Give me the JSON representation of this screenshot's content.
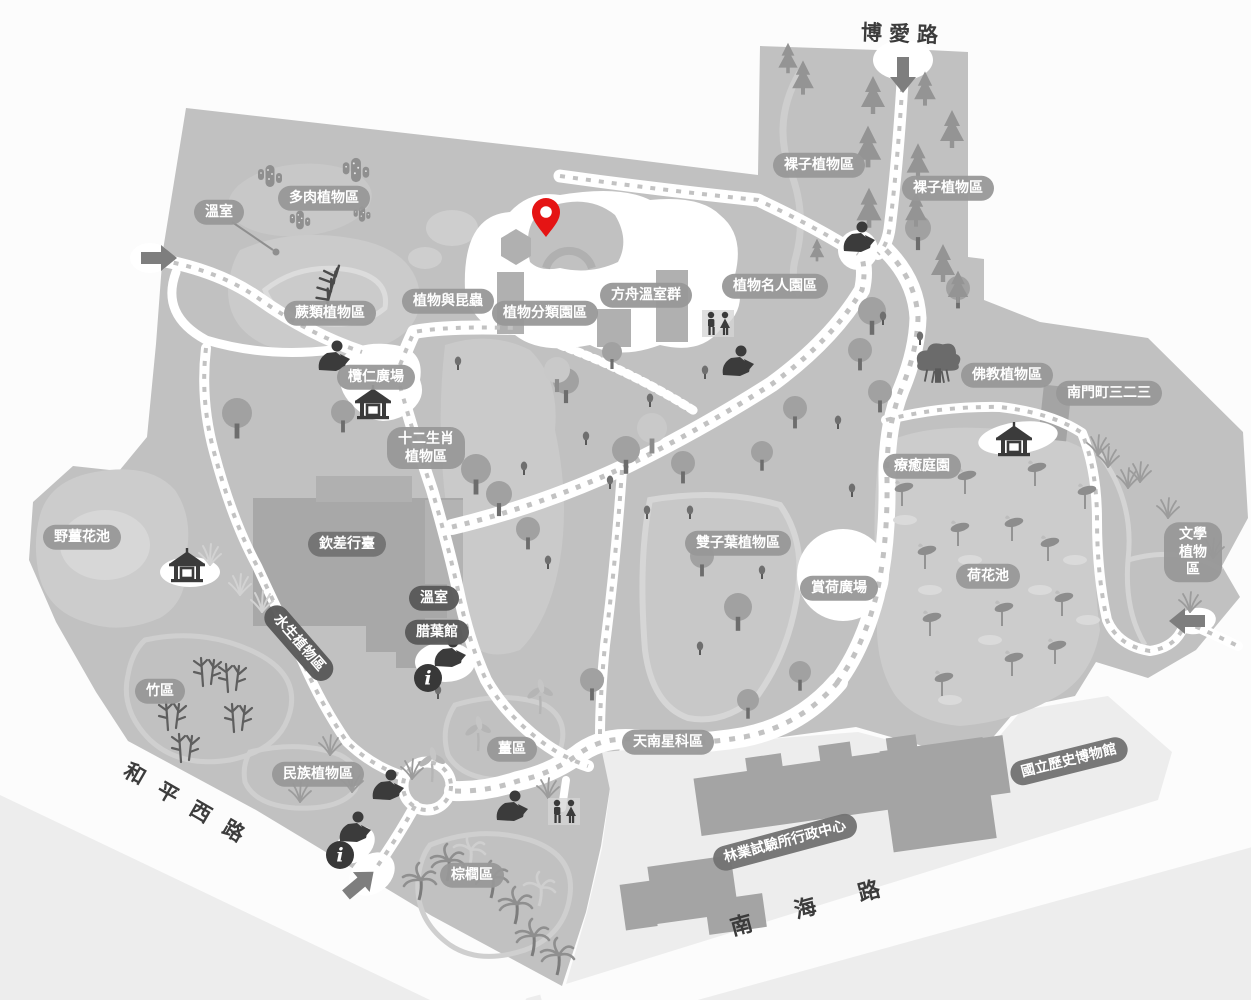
{
  "map_name": "botanical-garden-map",
  "colors": {
    "land": "#c1c1c1",
    "zone_light": "#cccccc",
    "zone_lighter": "#d7d7d7",
    "path_white": "#ffffff",
    "trail_dot": "#c2c2c2",
    "building": "#a6a6a6",
    "outside_block": "#ededed",
    "label_light_bg": "#989898",
    "label_medium_bg": "#747474",
    "label_dark_bg": "#5a5a5a",
    "road_text": "#3c3c3c",
    "icon_dark": "#3b3b3b",
    "pin_red": "#e51414"
  },
  "roads": [
    {
      "id": "boai",
      "text": "博愛路",
      "x": 903,
      "y": 33,
      "rot": 2,
      "ls": 7,
      "fs": 21
    },
    {
      "id": "heping-west",
      "text": "和平西路",
      "x": 192,
      "y": 806,
      "rot": 30,
      "ls": 17,
      "fs": 21
    },
    {
      "id": "nanhai",
      "text": "南海路",
      "x": 826,
      "y": 901,
      "rot": -15,
      "ls": 44,
      "fs": 22
    }
  ],
  "areas": [
    {
      "text": "溫室",
      "x": 219,
      "y": 212,
      "style": "light"
    },
    {
      "text": "多肉植物區",
      "x": 324,
      "y": 198,
      "style": "light"
    },
    {
      "text": "蕨類植物區",
      "x": 330,
      "y": 313,
      "style": "light"
    },
    {
      "text": "植物與昆蟲",
      "x": 448,
      "y": 301,
      "style": "light"
    },
    {
      "text": "植物分類園區",
      "x": 545,
      "y": 313,
      "style": "light"
    },
    {
      "text": "方舟溫室群",
      "x": 646,
      "y": 295,
      "style": "light"
    },
    {
      "text": "植物名人園區",
      "x": 775,
      "y": 286,
      "style": "light"
    },
    {
      "text": "裸子植物區",
      "x": 819,
      "y": 165,
      "style": "light"
    },
    {
      "text": "裸子植物區",
      "x": 948,
      "y": 188,
      "style": "light"
    },
    {
      "text": "欖仁廣場",
      "x": 376,
      "y": 377,
      "style": "light"
    },
    {
      "text": "十二生肖\n植物區",
      "x": 426,
      "y": 448,
      "style": "light"
    },
    {
      "text": "佛教植物區",
      "x": 1007,
      "y": 375,
      "style": "light"
    },
    {
      "text": "南門町三二三",
      "x": 1109,
      "y": 393,
      "style": "light"
    },
    {
      "text": "療癒庭園",
      "x": 922,
      "y": 466,
      "style": "light"
    },
    {
      "text": "野薑花池",
      "x": 82,
      "y": 537,
      "style": "light"
    },
    {
      "text": "欽差行臺",
      "x": 347,
      "y": 544,
      "style": "medium"
    },
    {
      "text": "雙子葉植物區",
      "x": 738,
      "y": 543,
      "style": "light"
    },
    {
      "text": "賞荷廣場",
      "x": 839,
      "y": 588,
      "style": "light"
    },
    {
      "text": "荷花池",
      "x": 988,
      "y": 576,
      "style": "light"
    },
    {
      "text": "文學植物區",
      "x": 1193,
      "y": 552,
      "style": "light"
    },
    {
      "text": "溫室",
      "x": 434,
      "y": 598,
      "style": "dark"
    },
    {
      "text": "腊葉館",
      "x": 437,
      "y": 632,
      "style": "dark"
    },
    {
      "text": "水生植物區",
      "x": 299,
      "y": 643,
      "style": "dark",
      "rot": 49
    },
    {
      "text": "竹區",
      "x": 160,
      "y": 691,
      "style": "light"
    },
    {
      "text": "民族植物區",
      "x": 318,
      "y": 774,
      "style": "light"
    },
    {
      "text": "薑區",
      "x": 512,
      "y": 749,
      "style": "light"
    },
    {
      "text": "天南星科區",
      "x": 668,
      "y": 742,
      "style": "light"
    },
    {
      "text": "棕櫚區",
      "x": 472,
      "y": 875,
      "style": "light"
    },
    {
      "text": "林業試驗所行政中心",
      "x": 785,
      "y": 842,
      "style": "medium",
      "rot": -15
    },
    {
      "text": "國立歷史博物館",
      "x": 1069,
      "y": 761,
      "style": "medium",
      "rot": -14
    }
  ],
  "icons": [
    {
      "t": "entrance-arrow",
      "x": 158,
      "y": 258,
      "r": 0
    },
    {
      "t": "entrance-arrow",
      "x": 903,
      "y": 74,
      "r": 90
    },
    {
      "t": "entrance-arrow",
      "x": 1188,
      "y": 621,
      "r": 180
    },
    {
      "t": "entrance-arrow",
      "x": 359,
      "y": 884,
      "r": -40
    },
    {
      "t": "info",
      "x": 428,
      "y": 678
    },
    {
      "t": "info",
      "x": 340,
      "y": 855
    },
    {
      "t": "restroom",
      "x": 718,
      "y": 324
    },
    {
      "t": "restroom",
      "x": 564,
      "y": 812
    },
    {
      "t": "pavilion",
      "x": 373,
      "y": 403
    },
    {
      "t": "pavilion",
      "x": 187,
      "y": 566
    },
    {
      "t": "pavilion",
      "x": 1014,
      "y": 440
    },
    {
      "t": "statue",
      "x": 333,
      "y": 357
    },
    {
      "t": "statue",
      "x": 737,
      "y": 362
    },
    {
      "t": "statue",
      "x": 858,
      "y": 238
    },
    {
      "t": "statue",
      "x": 387,
      "y": 786
    },
    {
      "t": "statue",
      "x": 511,
      "y": 807
    },
    {
      "t": "statue",
      "x": 354,
      "y": 828
    },
    {
      "t": "statue",
      "x": 449,
      "y": 653
    },
    {
      "t": "location-pin",
      "x": 546,
      "y": 237
    }
  ],
  "flora": [
    {
      "t": "tree",
      "x": 343,
      "y": 412,
      "s": 1.2
    },
    {
      "t": "tree",
      "x": 237,
      "y": 413,
      "s": 1.5
    },
    {
      "t": "tree",
      "x": 476,
      "y": 469,
      "s": 1.5
    },
    {
      "t": "tree",
      "x": 499,
      "y": 494,
      "s": 1.3
    },
    {
      "t": "tree",
      "x": 528,
      "y": 529,
      "s": 1.2
    },
    {
      "t": "tree",
      "x": 566,
      "y": 381,
      "s": 1.3
    },
    {
      "t": "tree",
      "x": 626,
      "y": 450,
      "s": 1.4
    },
    {
      "t": "tree",
      "x": 683,
      "y": 463,
      "s": 1.2
    },
    {
      "t": "tree",
      "x": 612,
      "y": 352,
      "s": 1.0
    },
    {
      "t": "tree",
      "x": 702,
      "y": 556,
      "s": 1.2
    },
    {
      "t": "tree",
      "x": 738,
      "y": 607,
      "s": 1.4
    },
    {
      "t": "tree",
      "x": 592,
      "y": 680,
      "s": 1.2
    },
    {
      "t": "tree",
      "x": 872,
      "y": 311,
      "s": 1.4
    },
    {
      "t": "tree",
      "x": 860,
      "y": 350,
      "s": 1.2
    },
    {
      "t": "tree",
      "x": 880,
      "y": 392,
      "s": 1.2
    },
    {
      "t": "tree",
      "x": 795,
      "y": 408,
      "s": 1.2
    },
    {
      "t": "tree",
      "x": 762,
      "y": 452,
      "s": 1.1
    },
    {
      "t": "tree",
      "x": 748,
      "y": 700,
      "s": 1.1
    },
    {
      "t": "tree",
      "x": 918,
      "y": 228,
      "s": 1.3
    },
    {
      "t": "tree",
      "x": 958,
      "y": 288,
      "s": 1.2
    },
    {
      "t": "tree",
      "x": 800,
      "y": 672,
      "s": 1.1
    },
    {
      "t": "tree-light",
      "x": 557,
      "y": 370,
      "s": 1.3
    },
    {
      "t": "tree-light",
      "x": 652,
      "y": 428,
      "s": 1.5
    },
    {
      "t": "conifer",
      "x": 873,
      "y": 100,
      "s": 1.0
    },
    {
      "t": "conifer",
      "x": 925,
      "y": 93,
      "s": 0.9
    },
    {
      "t": "conifer",
      "x": 952,
      "y": 134,
      "s": 1.0
    },
    {
      "t": "conifer",
      "x": 868,
      "y": 152,
      "s": 1.1
    },
    {
      "t": "conifer",
      "x": 918,
      "y": 166,
      "s": 0.95
    },
    {
      "t": "conifer",
      "x": 869,
      "y": 213,
      "s": 1.05
    },
    {
      "t": "conifer",
      "x": 916,
      "y": 214,
      "s": 0.9
    },
    {
      "t": "conifer",
      "x": 943,
      "y": 268,
      "s": 1.0
    },
    {
      "t": "conifer",
      "x": 958,
      "y": 291,
      "s": 0.85
    },
    {
      "t": "conifer",
      "x": 788,
      "y": 62,
      "s": 0.8
    },
    {
      "t": "conifer",
      "x": 803,
      "y": 82,
      "s": 0.9
    },
    {
      "t": "conifer",
      "x": 817,
      "y": 253,
      "s": 0.6
    },
    {
      "t": "bush",
      "x": 458,
      "y": 363
    },
    {
      "t": "bush",
      "x": 705,
      "y": 372
    },
    {
      "t": "bush",
      "x": 650,
      "y": 400
    },
    {
      "t": "bush",
      "x": 838,
      "y": 422
    },
    {
      "t": "bush",
      "x": 610,
      "y": 482
    },
    {
      "t": "bush",
      "x": 647,
      "y": 512
    },
    {
      "t": "bush",
      "x": 690,
      "y": 512
    },
    {
      "t": "bush",
      "x": 852,
      "y": 490
    },
    {
      "t": "bush",
      "x": 762,
      "y": 572
    },
    {
      "t": "bush",
      "x": 548,
      "y": 562
    },
    {
      "t": "bush",
      "x": 438,
      "y": 692
    },
    {
      "t": "bush",
      "x": 920,
      "y": 338
    },
    {
      "t": "bush",
      "x": 700,
      "y": 648
    },
    {
      "t": "bush",
      "x": 883,
      "y": 318
    },
    {
      "t": "bush",
      "x": 586,
      "y": 438
    },
    {
      "t": "bush",
      "x": 524,
      "y": 468
    },
    {
      "t": "cactus",
      "x": 270,
      "y": 176,
      "s": 1.0
    },
    {
      "t": "cactus",
      "x": 356,
      "y": 170,
      "s": 1.1
    },
    {
      "t": "cactus",
      "x": 300,
      "y": 220,
      "s": 0.85
    },
    {
      "t": "cactus",
      "x": 362,
      "y": 214,
      "s": 0.7
    },
    {
      "t": "fern",
      "x": 330,
      "y": 288,
      "r": -15,
      "s": 1.2
    },
    {
      "t": "banyan",
      "x": 938,
      "y": 366,
      "s": 1.2
    },
    {
      "t": "bamboo",
      "x": 207,
      "y": 672
    },
    {
      "t": "bamboo",
      "x": 232,
      "y": 678
    },
    {
      "t": "bamboo",
      "x": 238,
      "y": 718
    },
    {
      "t": "bamboo",
      "x": 172,
      "y": 716
    },
    {
      "t": "bamboo",
      "x": 185,
      "y": 748
    },
    {
      "t": "palm",
      "x": 492,
      "y": 880
    },
    {
      "t": "palm",
      "x": 516,
      "y": 906
    },
    {
      "t": "palm",
      "x": 533,
      "y": 938
    },
    {
      "t": "palm",
      "x": 558,
      "y": 957
    },
    {
      "t": "palm",
      "x": 448,
      "y": 863
    },
    {
      "t": "palm",
      "x": 420,
      "y": 882
    },
    {
      "t": "palm-light",
      "x": 470,
      "y": 852
    },
    {
      "t": "palm-light",
      "x": 540,
      "y": 890
    },
    {
      "t": "lotus",
      "x": 925,
      "y": 555
    },
    {
      "t": "lotus",
      "x": 958,
      "y": 532
    },
    {
      "t": "lotus",
      "x": 1012,
      "y": 527
    },
    {
      "t": "lotus",
      "x": 1048,
      "y": 547
    },
    {
      "t": "lotus",
      "x": 930,
      "y": 622
    },
    {
      "t": "lotus",
      "x": 1002,
      "y": 612
    },
    {
      "t": "lotus",
      "x": 1062,
      "y": 602
    },
    {
      "t": "lotus",
      "x": 942,
      "y": 682
    },
    {
      "t": "lotus",
      "x": 1012,
      "y": 662
    },
    {
      "t": "lotus",
      "x": 902,
      "y": 492
    },
    {
      "t": "lotus",
      "x": 965,
      "y": 480
    },
    {
      "t": "lotus",
      "x": 1035,
      "y": 472
    },
    {
      "t": "lotus",
      "x": 1085,
      "y": 495
    },
    {
      "t": "lotus",
      "x": 1055,
      "y": 650
    },
    {
      "t": "lilypad",
      "x": 905,
      "y": 520
    },
    {
      "t": "lilypad",
      "x": 970,
      "y": 560
    },
    {
      "t": "lilypad",
      "x": 1040,
      "y": 590
    },
    {
      "t": "lilypad",
      "x": 990,
      "y": 640
    },
    {
      "t": "lilypad",
      "x": 930,
      "y": 590
    },
    {
      "t": "lilypad",
      "x": 1075,
      "y": 560
    },
    {
      "t": "lilypad",
      "x": 950,
      "y": 700
    },
    {
      "t": "lilypad",
      "x": 1088,
      "y": 620
    },
    {
      "t": "grass",
      "x": 1108,
      "y": 457
    },
    {
      "t": "grass",
      "x": 1140,
      "y": 472
    },
    {
      "t": "grass",
      "x": 1168,
      "y": 508
    },
    {
      "t": "grass",
      "x": 1190,
      "y": 602
    },
    {
      "t": "grass",
      "x": 1213,
      "y": 548
    },
    {
      "t": "grass",
      "x": 1098,
      "y": 445
    },
    {
      "t": "grass",
      "x": 1128,
      "y": 478
    },
    {
      "t": "grass",
      "x": 330,
      "y": 745
    },
    {
      "t": "grass",
      "x": 352,
      "y": 782
    },
    {
      "t": "grass",
      "x": 300,
      "y": 792
    },
    {
      "t": "grass",
      "x": 412,
      "y": 769
    },
    {
      "t": "grass",
      "x": 548,
      "y": 788
    },
    {
      "t": "grass-light",
      "x": 240,
      "y": 585
    },
    {
      "t": "grass-light",
      "x": 262,
      "y": 602
    },
    {
      "t": "grass-light",
      "x": 210,
      "y": 555
    },
    {
      "t": "heliconia",
      "x": 540,
      "y": 700
    },
    {
      "t": "heliconia",
      "x": 478,
      "y": 737
    },
    {
      "t": "heliconia",
      "x": 432,
      "y": 768
    }
  ]
}
